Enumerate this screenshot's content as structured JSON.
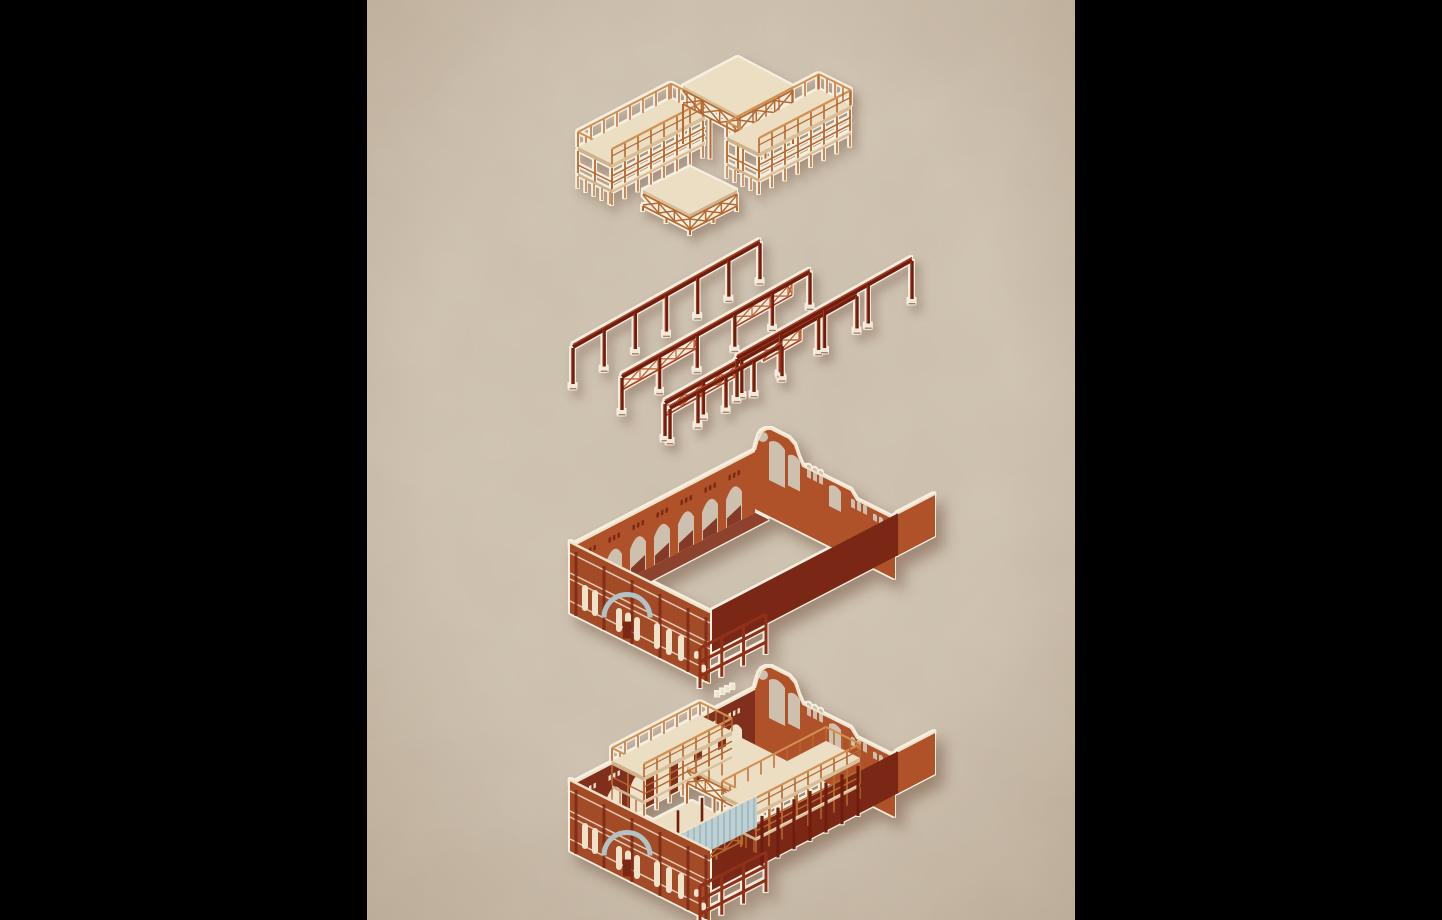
{
  "poster": {
    "background_color": "#000000",
    "panel": {
      "left_px": 367,
      "width_px": 708,
      "height_px": 920,
      "paper_color": "#cdc0ae"
    },
    "illustration": {
      "type": "exploded-axonometric-building-diagram",
      "layers": [
        {
          "id": "timber-roof-decks",
          "label": "timber deck and roof frames",
          "piece_count": 4
        },
        {
          "id": "steel-frame-grid",
          "label": "steel column and beam rows with lattice girders",
          "row_count": 5
        },
        {
          "id": "masonry-shell",
          "label": "brick masonry shell with arcade, gable and facade"
        },
        {
          "id": "assembled-building",
          "label": "assembled building with interior decks, columns and corrugated fence"
        }
      ]
    },
    "palette": {
      "paper": "#cdc0ae",
      "paperLight": "#ded3c1",
      "paperDark": "#b7a791",
      "timberFrame": "#b5682f",
      "timberLight": "#d29050",
      "slabFill": "#ecdec2",
      "slabEdge": "#d9bd97",
      "slabEdgeDark": "#cdb28c",
      "steelDark": "#6e1d0e",
      "steelHi": "#a83f25",
      "lattice": "#c05f33",
      "baseCream": "#f1e9d8",
      "brickBright": "#b05229",
      "brickMid": "#a34b26",
      "brickDark": "#7b2715",
      "floorShadow": "#82301b",
      "innerWall": "#7f2f1c",
      "creamDetail": "#eee2cb",
      "outline": "#f6efe0",
      "greyArch": "#b3c2c5",
      "fenceBlue": "#bdd0d4",
      "fenceRib": "#9cb2b8"
    }
  }
}
